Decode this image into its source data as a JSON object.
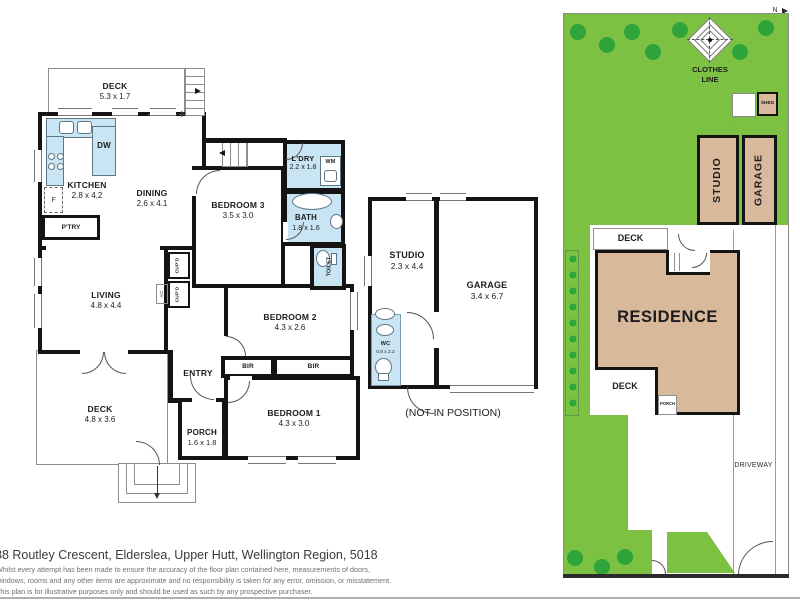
{
  "main": {
    "deck_top": {
      "name": "DECK",
      "dims": "5.3 x 1.7"
    },
    "kitchen": {
      "name": "KITCHEN",
      "dims": "2.8 x 4.2"
    },
    "dining": {
      "name": "DINING",
      "dims": "2.6 x 4.1"
    },
    "bedroom3": {
      "name": "BEDROOM 3",
      "dims": "3.5 x 3.0"
    },
    "ldry": {
      "name": "L'DRY",
      "dims": "2.2 x 1.8"
    },
    "bath": {
      "name": "BATH",
      "dims": "1.8 x 1.6"
    },
    "toilet": {
      "name": "TOILET"
    },
    "living": {
      "name": "LIVING",
      "dims": "4.8 x 4.4"
    },
    "entry": {
      "name": "ENTRY"
    },
    "bedroom2": {
      "name": "BEDROOM 2",
      "dims": "4.3 x 2.6"
    },
    "bir_left": {
      "name": "BIR"
    },
    "bir_right": {
      "name": "BIR"
    },
    "bedroom1": {
      "name": "BEDROOM 1",
      "dims": "4.3 x 3.0"
    },
    "deck_bottom": {
      "name": "DECK",
      "dims": "4.8 x 3.6"
    },
    "porch": {
      "name": "PORCH",
      "dims": "1.6 x 1.8"
    },
    "fixtures": {
      "dw": "DW",
      "fridge": "F",
      "pantry": "P'TRY",
      "wm": "WM",
      "cupd1": "CUP'D",
      "cupd2": "CUP'D",
      "ac": "A/C"
    }
  },
  "outbuilding": {
    "studio": {
      "name": "STUDIO",
      "dims": "2.3 x 4.4"
    },
    "garage": {
      "name": "GARAGE",
      "dims": "3.4 x 6.7"
    },
    "wc": {
      "name": "WC",
      "dims": "0.8 x 2.2"
    },
    "note": "(NOT IN POSITION)"
  },
  "site": {
    "north_label": "N",
    "clothes_line": "CLOTHES LINE",
    "shed": "SHED",
    "studio": "STUDIO",
    "garage": "GARAGE",
    "deck_upper": "DECK",
    "residence": "RESIDENCE",
    "deck_lower": "DECK",
    "porch": "PORCH",
    "driveway": "DRIVEWAY"
  },
  "footer": {
    "address": "88 Routley Crescent, Elderslea, Upper Hutt, Wellington Region, 5018",
    "disclaimer": [
      "Whilst every attempt has been made to ensure the accuracy of the floor plan contained here, measurements of doors,",
      "windows, rooms and any other items are approximate and no responsibility is taken for any error, omission, or misstatement.",
      "This plan is for illustrative purposes only and should be used as such by any prospective purchaser."
    ]
  },
  "colors": {
    "fixture_blue": "#c9e4f3",
    "lawn_green": "#7cc142",
    "tree_green": "#2fa43a",
    "building_tan": "#d9b99c",
    "wall_black": "#141414"
  },
  "icons": {
    "tree": "filled-circle",
    "north_arrow": "right-triangle",
    "clothes_line": "nested-diamond-with-dashed-cross",
    "stairs": "parallel-lines-with-arrow",
    "sink": "rounded-square",
    "cooktop": "four-circles",
    "bathtub": "ellipse",
    "basin": "ellipse",
    "toilet_pan": "ellipse-with-cistern"
  }
}
